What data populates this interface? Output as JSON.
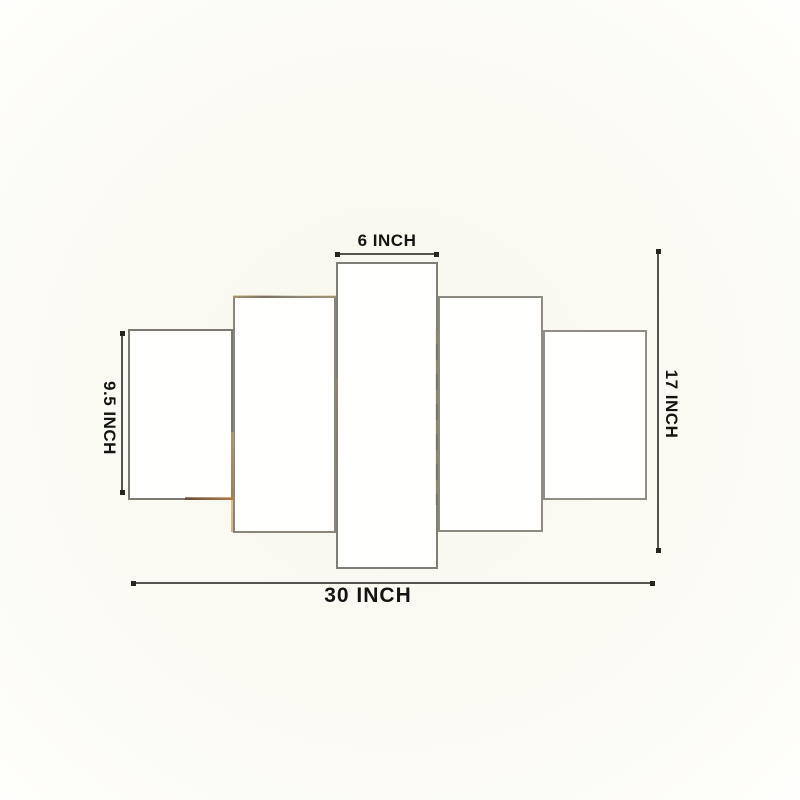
{
  "diagram": {
    "description": "Size guide diagram for a 5-piece wall art canvas set",
    "panel_count": 5,
    "labels": {
      "top_width": "6 INCH",
      "left_height": "9.5 INCH",
      "right_height": "17 INCH",
      "bottom_width": "30 INCH"
    },
    "colors": {
      "background": "#fbfaf3",
      "panel_fill": "#fffffe",
      "panel_border": "#88847b",
      "dimension_line": "#55534e",
      "end_marker": "#262521",
      "label_text": "#141414",
      "edge_fleck_gold": "#cda555",
      "edge_fleck_brown": "#583214"
    }
  }
}
